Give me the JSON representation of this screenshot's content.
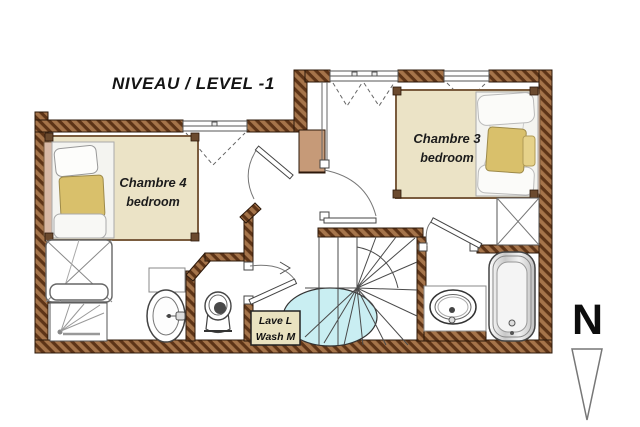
{
  "title": "NIVEAU / LEVEL -1",
  "rooms": {
    "chambre4": {
      "name": "Chambre 4",
      "subtitle": "bedroom"
    },
    "chambre3": {
      "name": "Chambre 3",
      "subtitle": "bedroom"
    },
    "laundry": {
      "line1": "Lave L",
      "line2": "Wash M"
    }
  },
  "compass": {
    "letter": "N"
  },
  "colors": {
    "wall_brown": "#a5744a",
    "wall_brown_dark": "#5d3417",
    "bed_platform_beige": "#ebe3c6",
    "pillow_yellow": "#d9c06b",
    "chimney_tan": "#c69a78",
    "headboard_tan": "#d8b9a6",
    "stair_ellipse_cyan": "#c9eef2",
    "laundry_box_beige": "#e9e2c0",
    "line_dark": "#444444"
  },
  "icons": {
    "north_arrow": "north-arrow-icon"
  }
}
